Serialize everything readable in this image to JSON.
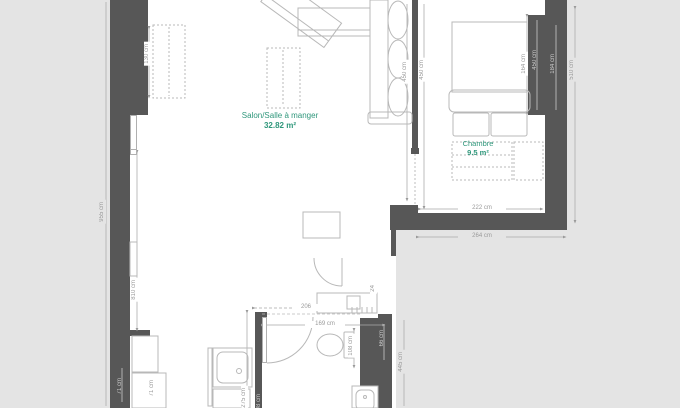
{
  "plan": {
    "type": "apartment-floor-plan",
    "rooms": {
      "salon": {
        "name": "Salon/Salle à manger",
        "area": "32.82 m²"
      },
      "chambre": {
        "name": "Chambre",
        "area": "9.5 m²"
      }
    },
    "dimensions": {
      "left_total": "955 cm",
      "left_inner": "810 cm",
      "sideboard": "130 cm",
      "salon_height": "450 cm",
      "chambre_height": "450 cm",
      "bed_width": "164 cm",
      "wall_segment": "450 cm",
      "wall_right_inner": "184 cm",
      "right_total": "510 cm",
      "chambre_width_inner": "222 cm",
      "chambre_width_outer": "264 cm",
      "kitchen_run": "206",
      "bath_width": "169 cm",
      "wc_depth": "108 cm",
      "duct_width": "66 cm",
      "lower_right": "445 cm",
      "shower_zone_height": "275 cm",
      "shower_width": "108 cm",
      "column_a": "71 cm",
      "column_b": "71 cm",
      "counter_depth": "24"
    },
    "colors": {
      "background": "#e4e4e4",
      "floor": "#ffffff",
      "wall": "#575757",
      "furniture_stroke": "#b8b8b8",
      "dimension_text": "#9a9a9a",
      "dimension_text_on_wall": "#c9c9c9",
      "room_label": "#2f977b"
    }
  }
}
